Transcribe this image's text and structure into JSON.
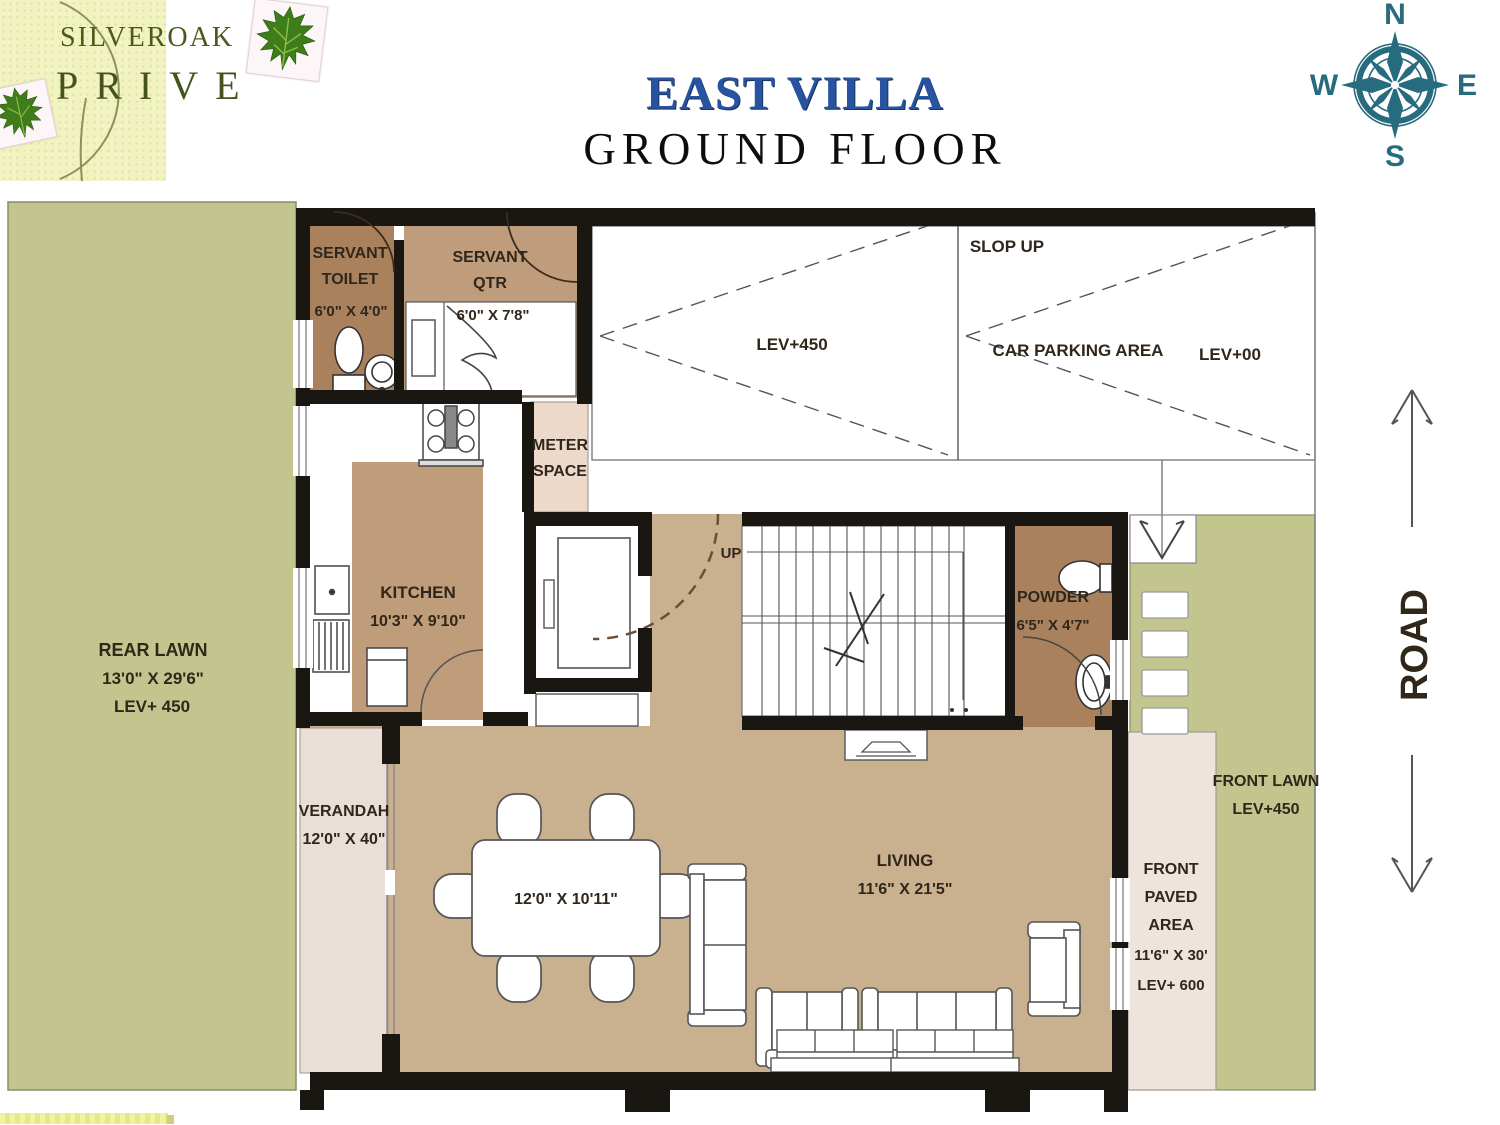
{
  "logo": {
    "brand": "SILVEROAK",
    "brand2": "PRIVE"
  },
  "header": {
    "title": "EAST VILLA",
    "subtitle": "GROUND FLOOR"
  },
  "compass": {
    "n": "N",
    "e": "E",
    "s": "S",
    "w": "W"
  },
  "colors": {
    "lawn": "#c2c68e",
    "floor_tan": "#c9b190",
    "room_brown": "#a9825d",
    "qtr_brown": "#bf9d7c",
    "pale_pink": "#eadfd7",
    "wall": "#1a1611",
    "title_blue": "#2753a0",
    "compass_teal": "#266b7e"
  },
  "plan": {
    "rear_lawn": {
      "name": "REAR LAWN",
      "dim": "13'0\" X 29'6\"",
      "level": "LEV+ 450"
    },
    "servant_toilet": {
      "name1": "SERVANT",
      "name2": "TOILET",
      "dim": "6'0\" X 4'0\""
    },
    "servant_qtr": {
      "name1": "SERVANT",
      "name2": "QTR",
      "dim": "6'0\" X 7'8\""
    },
    "parking": {
      "slope": "SLOP UP",
      "lev_left": "LEV+450",
      "name": "CAR PARKING AREA",
      "lev_right": "LEV+00"
    },
    "meter": {
      "name1": "METER",
      "name2": "SPACE"
    },
    "kitchen": {
      "name": "KITCHEN",
      "dim": "10'3\" X 9'10\""
    },
    "stairs": {
      "up": "UP"
    },
    "powder": {
      "name": "POWDER",
      "dim": "6'5\" X 4'7\""
    },
    "verandah": {
      "name": "VERANDAH",
      "dim": "12'0\" X 40\""
    },
    "dining": {
      "dim": "12'0\" X 10'11\""
    },
    "living": {
      "name": "LIVING",
      "dim": "11'6\" X 21'5\""
    },
    "front_lawn": {
      "name": "FRONT LAWN",
      "level": "LEV+450"
    },
    "front_paved": {
      "name1": "FRONT",
      "name2": "PAVED",
      "name3": "AREA",
      "dim": "11'6\" X 30'",
      "level": "LEV+ 600"
    },
    "road": {
      "name": "ROAD"
    }
  }
}
